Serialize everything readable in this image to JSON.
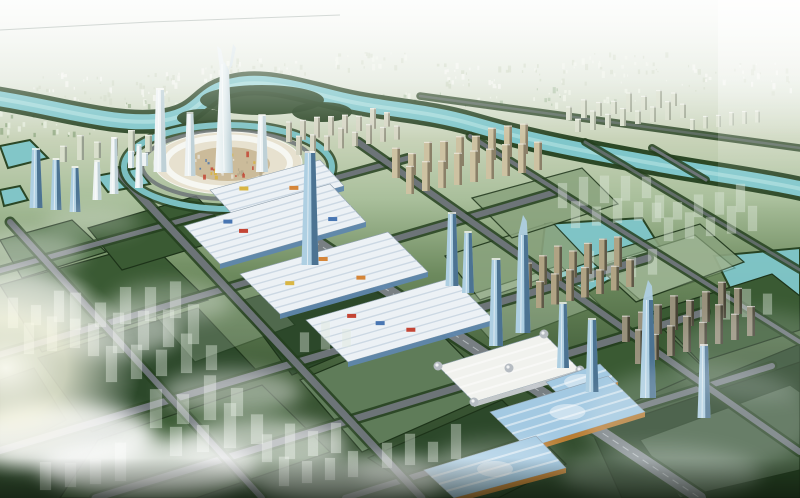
{
  "meta": {
    "description": "aerial-masterplan-rendering",
    "image_type": "architectural-visualization"
  },
  "scene": {
    "palette": {
      "sky_top": "#f0f3ed",
      "sky_mid": "#c8d3b8",
      "plain": "#a9bf9b",
      "river": "#7fc6ca",
      "river_hi": "#bce8e6",
      "tree": "#24401f",
      "parcel_dark": "#2c482a",
      "parcel_mid": "#3a5a33",
      "parcel_light": "#52734a",
      "parcel_pale": "#8aa37e",
      "road": "#6d7478",
      "axis": "#787f83",
      "hall_roof": "#ecf1f5",
      "hall_blue": "#5f87ad",
      "hall_stripe": "#c9d6e2",
      "mall_white": "#f1f2ee",
      "dome": "#b6bcc2",
      "bighall_roof": "#a3c9e2",
      "bighall_trim": "#c08034",
      "tower_blue_light": "#aecfe2",
      "tower_blue": "#6e9cba",
      "tower_blue_dark": "#41688a",
      "tower_white": "#eef3f4",
      "tower_white_shade": "#b9cdd4",
      "slab_tan": "#cdc2a2",
      "slab_tan_dark": "#8a8068",
      "slab_pale": "#d9dfcc",
      "ghost": "#dfe9dc",
      "plaza_ring": "#f6f7f2",
      "plaza_fill": "#e7e1cf",
      "cloud": "#ffffff",
      "glow": "#fffdf2",
      "haze_blue": "#e6eef0"
    },
    "accents": [
      "#c23b2a",
      "#d8b23a",
      "#3f6fae",
      "#d4802e"
    ],
    "river": {
      "d": "M -5,98 C 60,108 120,128 166,120 C 204,113 198,92 236,85 C 266,79 300,90 334,98 C 382,110 424,110 472,124 C 540,144 602,154 662,165 C 712,174 762,180 806,190",
      "islands": [
        [
          262,
          100,
          62,
          15
        ],
        [
          322,
          112,
          30,
          10
        ],
        [
          203,
          118,
          26,
          9
        ]
      ]
    },
    "canal": {
      "cx": 228,
      "cy": 167,
      "rx": 104,
      "ry": 42,
      "roadRx": 86,
      "roadRy": 34
    },
    "lakes": [
      "545,224 642,218 662,250 588,292 540,268",
      "714,256 800,248 800,306 736,300",
      "0,146 30,140 48,158 8,168",
      "96,176 138,168 150,184 108,192",
      "0,190 20,186 28,200 4,206"
    ],
    "parcels": [
      {
        "pts": "0,285 150,243 208,300 42,352",
        "c": "parcel_mid"
      },
      {
        "pts": "38,358 198,308 258,372 92,432",
        "c": "parcel_dark"
      },
      {
        "pts": "98,440 262,385 330,452 196,498 60,498",
        "c": "parcel_mid"
      },
      {
        "pts": "238,302 362,263 418,322 292,375",
        "c": "parcel_dark"
      },
      {
        "pts": "300,380 432,325 498,392 362,452",
        "c": "parcel_mid"
      },
      {
        "pts": "368,458 502,400 566,464 498,498 430,498",
        "c": "parcel_dark"
      },
      {
        "pts": "445,256 552,222 590,262 480,300",
        "c": "parcel_pale",
        "o": 0.9
      },
      {
        "pts": "472,198 582,168 618,204 512,238",
        "c": "parcel_pale",
        "o": 0.85
      },
      {
        "pts": "588,258 700,224 744,262 636,302",
        "c": "parcel_pale",
        "o": 0.9
      },
      {
        "pts": "652,312 772,274 800,296 800,330 700,362",
        "c": "parcel_mid"
      },
      {
        "pts": "702,384 800,344 800,430 762,432",
        "c": "parcel_dark"
      },
      {
        "pts": "560,362 662,328 706,370 610,412",
        "c": "parcel_mid"
      },
      {
        "pts": "88,228 196,196 234,236 122,270",
        "c": "parcel_mid"
      },
      {
        "pts": "0,240 72,220 106,252 22,278",
        "c": "parcel_light"
      },
      {
        "pts": "592,432 800,362 800,498 622,498",
        "c": "#233d20"
      },
      {
        "pts": "0,380 34,368 66,420 0,454",
        "c": "parcel_dark"
      },
      {
        "pts": "300,380 432,325 498,392 362,452",
        "c": "#cfe0ca",
        "o": 0.25
      },
      {
        "pts": "455,300 560,265 600,305 495,345",
        "c": "#cfe0ca",
        "o": 0.3
      },
      {
        "pts": "600,265 695,235 735,268 640,300",
        "c": "#cfe0ca",
        "o": 0.25
      },
      {
        "pts": "150,310 250,275 295,325 195,362",
        "c": "#cfe0ca",
        "o": 0.22
      },
      {
        "pts": "640,440 790,385 800,392 800,470 680,498",
        "c": "#cfe0ca",
        "o": 0.2
      }
    ],
    "roads": [
      {
        "d": "M-5,272 L408,158",
        "w": 5
      },
      {
        "d": "M-5,356 L556,192",
        "w": 6
      },
      {
        "d": "M-5,452 L648,258",
        "w": 7
      },
      {
        "d": "M95,498 L705,312",
        "w": 7
      },
      {
        "d": "M345,498 L772,366",
        "w": 6
      },
      {
        "d": "M10,222 L262,498",
        "w": 6
      },
      {
        "d": "M118,172 L422,498",
        "w": 7
      },
      {
        "d": "M243,194 L700,498",
        "w": 12,
        "main": true
      },
      {
        "d": "M358,142 L800,452",
        "w": 6
      },
      {
        "d": "M470,136 L800,342",
        "w": 4
      },
      {
        "d": "M585,142 L800,270",
        "w": 3,
        "o": 0.8
      },
      {
        "d": "M652,148 L706,180",
        "w": 3
      },
      {
        "d": "M420,96 L800,148",
        "w": 2.5,
        "o": 0.6
      }
    ],
    "speckles": [
      {
        "x": 30,
        "y": 72,
        "w": 150,
        "h": 28,
        "n": 55,
        "cols": [
          "#f3f5ee",
          "#cdd6c2"
        ]
      },
      {
        "x": 200,
        "y": 58,
        "w": 110,
        "h": 22,
        "n": 40,
        "cols": [
          "#f3f5ee",
          "#cdd6c2"
        ]
      },
      {
        "x": 330,
        "y": 52,
        "w": 80,
        "h": 16,
        "n": 26,
        "cols": [
          "#eef2e8",
          "#cdd6c2"
        ]
      },
      {
        "x": 430,
        "y": 62,
        "w": 110,
        "h": 24,
        "n": 36,
        "cols": [
          "#f3f5ee",
          "#c6d2ba"
        ]
      },
      {
        "x": 560,
        "y": 52,
        "w": 110,
        "h": 30,
        "n": 40,
        "cols": [
          "#eef2e8",
          "#cdd6c2"
        ]
      },
      {
        "x": 680,
        "y": 62,
        "w": 110,
        "h": 30,
        "n": 36,
        "cols": [
          "#f3f5ee",
          "#cdd6c2"
        ]
      },
      {
        "x": 0,
        "y": 108,
        "w": 95,
        "h": 28,
        "n": 30,
        "cols": [
          "#e8eee0",
          "#8fa882"
        ]
      },
      {
        "x": 110,
        "y": 100,
        "w": 90,
        "h": 24,
        "n": 26,
        "cols": [
          "#e8eee0",
          "#8fa882"
        ]
      },
      {
        "x": 380,
        "y": 92,
        "w": 120,
        "h": 20,
        "n": 30,
        "cols": [
          "#edf2e6",
          "#a9bfa0"
        ]
      },
      {
        "x": 520,
        "y": 86,
        "w": 120,
        "h": 18,
        "n": 26,
        "cols": [
          "#edf2e6",
          "#a9bfa0"
        ]
      },
      {
        "g": "plaza",
        "x": 192,
        "y": 150,
        "w": 72,
        "h": 26,
        "n": 42,
        "cols": [
          "#c23b2a",
          "#e8e4da",
          "#3f6fae",
          "#d8b23a",
          "#b0a488"
        ]
      }
    ],
    "halls": [
      {
        "pts": "210,190 320,160 344,186 234,216",
        "n": 5
      },
      {
        "pts": "184,226 330,184 366,222 220,264",
        "n": 7
      },
      {
        "pts": "240,274 388,232 428,272 280,314",
        "n": 7
      },
      {
        "pts": "306,320 452,278 494,320 348,362",
        "n": 7
      },
      {
        "pts": "438,366 544,334 580,370 474,402",
        "n": 5,
        "t": "mall"
      },
      {
        "pts": "546,382 600,364 618,382 564,400",
        "n": 3,
        "t": "bighall"
      },
      {
        "pts": "490,412 608,376 645,412 527,448",
        "n": 5,
        "t": "bighall"
      },
      {
        "pts": "424,470 536,436 566,468 454,498",
        "n": 4,
        "t": "bighall"
      }
    ],
    "slabs": [
      {
        "x": 392,
        "y": 178,
        "cols": 9,
        "rows": 2,
        "bw": 8,
        "bh": 26,
        "gx": 8,
        "gy": 16,
        "rdx": 14,
        "cdy": -3,
        "f": "#cdc2a2",
        "s": "#8a8068"
      },
      {
        "x": 286,
        "y": 142,
        "cols": 8,
        "rows": 2,
        "bw": 6,
        "bh": 17,
        "gx": 8,
        "gy": 13,
        "rdx": 10,
        "cdy": -2.2,
        "f": "#d6d6c4",
        "s": "#9a9a88"
      },
      {
        "x": 566,
        "y": 120,
        "cols": 8,
        "rows": 2,
        "bw": 6,
        "bh": 16,
        "gx": 9,
        "gy": 12,
        "rdx": 9,
        "cdy": -2,
        "f": "#d9dfcc",
        "s": "#a0a894"
      },
      {
        "x": 524,
        "y": 288,
        "cols": 7,
        "rows": 2,
        "bw": 8,
        "bh": 30,
        "gx": 7,
        "gy": 20,
        "rdx": 12,
        "cdy": -3.5,
        "f": "#b0a384",
        "s": "#5f5948"
      },
      {
        "x": 622,
        "y": 342,
        "cols": 8,
        "rows": 2,
        "bw": 8,
        "bh": 32,
        "gx": 8,
        "gy": 22,
        "rdx": 13,
        "cdy": -4,
        "f": "#98917c",
        "s": "#474335"
      },
      {
        "x": 60,
        "y": 162,
        "cols": 6,
        "rows": 1,
        "bw": 7,
        "bh": 20,
        "gx": 10,
        "gy": 0,
        "rdx": 0,
        "cdy": -2,
        "f": "#d9dfcc",
        "s": "#98a090"
      },
      {
        "x": 690,
        "y": 130,
        "cols": 6,
        "rows": 1,
        "bw": 5,
        "bh": 12,
        "gx": 8,
        "gy": 0,
        "rdx": 0,
        "cdy": -1.5,
        "f": "#dce2d0",
        "s": "#aab4a0"
      },
      {
        "x": 128,
        "y": 168,
        "cols": 3,
        "rows": 1,
        "bw": 6,
        "bh": 16,
        "gx": 8,
        "gy": 0,
        "rdx": 0,
        "cdy": -2,
        "f": "#eef3f4",
        "s": "#b9cdd4"
      }
    ],
    "ghosts": [
      {
        "x": 70,
        "y": 330,
        "cols": 5,
        "rows": 3,
        "bw": 11,
        "gx": 14,
        "gy": 26,
        "rdx": 18,
        "cdy": -3,
        "bh": 30
      },
      {
        "x": 150,
        "y": 428,
        "cols": 4,
        "rows": 2,
        "bw": 12,
        "gx": 15,
        "gy": 28,
        "rdx": 20,
        "cdy": -4,
        "bh": 34
      },
      {
        "x": 262,
        "y": 462,
        "cols": 4,
        "rows": 2,
        "bw": 10,
        "gx": 13,
        "gy": 24,
        "rdx": 17,
        "cdy": -3,
        "bh": 28
      },
      {
        "x": 382,
        "y": 468,
        "cols": 4,
        "rows": 1,
        "bw": 10,
        "gx": 13,
        "gy": 0,
        "rdx": 0,
        "cdy": -3,
        "bh": 26
      },
      {
        "x": 558,
        "y": 208,
        "cols": 5,
        "rows": 2,
        "bw": 9,
        "gx": 12,
        "gy": 20,
        "rdx": 13,
        "cdy": -2.5,
        "bh": 24
      },
      {
        "x": 652,
        "y": 222,
        "cols": 5,
        "rows": 2,
        "bw": 9,
        "gx": 12,
        "gy": 19,
        "rdx": 12,
        "cdy": -2.5,
        "bh": 22
      },
      {
        "x": 585,
        "y": 282,
        "cols": 4,
        "rows": 1,
        "bw": 9,
        "gx": 12,
        "gy": 0,
        "rdx": 0,
        "cdy": -2.5,
        "bh": 24
      },
      {
        "x": 700,
        "y": 322,
        "cols": 4,
        "rows": 1,
        "bw": 9,
        "gx": 12,
        "gy": 0,
        "rdx": 0,
        "cdy": -2.5,
        "bh": 22
      },
      {
        "x": 8,
        "y": 328,
        "cols": 3,
        "rows": 2,
        "bw": 10,
        "gx": 13,
        "gy": 26,
        "rdx": 16,
        "cdy": -3,
        "bh": 26
      },
      {
        "x": 300,
        "y": 352,
        "cols": 3,
        "rows": 1,
        "bw": 9,
        "gx": 12,
        "gy": 0,
        "rdx": 0,
        "cdy": -2.5,
        "bh": 22
      },
      {
        "x": 40,
        "y": 490,
        "cols": 4,
        "rows": 1,
        "bw": 11,
        "gx": 14,
        "gy": 0,
        "rdx": 0,
        "cdy": -3,
        "bh": 30
      }
    ],
    "towers": [
      [
        160,
        172,
        13,
        82,
        "white"
      ],
      [
        190,
        176,
        11,
        62,
        "white"
      ],
      [
        114,
        194,
        9,
        55,
        "white"
      ],
      [
        262,
        172,
        12,
        56,
        "white"
      ],
      [
        139,
        188,
        8,
        42,
        "white"
      ],
      [
        97,
        200,
        9,
        38,
        "white"
      ],
      [
        36,
        208,
        13,
        58,
        "blue"
      ],
      [
        56,
        210,
        11,
        50,
        "blue"
      ],
      [
        75,
        212,
        11,
        44,
        "blue"
      ],
      [
        310,
        265,
        17,
        112,
        "blue"
      ],
      [
        452,
        286,
        13,
        72,
        "blue"
      ],
      [
        468,
        293,
        12,
        60,
        "blue"
      ],
      [
        496,
        346,
        14,
        86,
        "blue"
      ],
      [
        523,
        333,
        15,
        98,
        "crystal"
      ],
      [
        563,
        368,
        12,
        64,
        "blue"
      ],
      [
        592,
        392,
        13,
        72,
        "blue"
      ],
      [
        648,
        398,
        16,
        98,
        "crystal"
      ],
      [
        704,
        418,
        13,
        72,
        "blue"
      ]
    ],
    "clouds": [
      [
        15,
        300,
        70,
        30,
        0.6
      ],
      [
        24,
        252,
        60,
        22,
        0.4
      ],
      [
        92,
        222,
        48,
        14,
        0.25
      ],
      [
        105,
        332,
        75,
        26,
        0.5
      ],
      [
        172,
        302,
        60,
        20,
        0.3
      ],
      [
        60,
        436,
        95,
        34,
        0.85
      ],
      [
        150,
        468,
        110,
        30,
        0.8
      ],
      [
        232,
        392,
        70,
        22,
        0.45
      ],
      [
        262,
        444,
        85,
        26,
        0.6
      ],
      [
        348,
        482,
        95,
        24,
        0.55
      ],
      [
        428,
        474,
        70,
        18,
        0.35
      ],
      [
        500,
        455,
        60,
        16,
        0.25
      ],
      [
        700,
        420,
        115,
        55,
        0.22,
        "#e6eef0"
      ],
      [
        760,
        356,
        85,
        45,
        0.18,
        "#e6eef0"
      ],
      [
        660,
        474,
        100,
        28,
        0.25,
        "#eef4f4"
      ]
    ]
  }
}
